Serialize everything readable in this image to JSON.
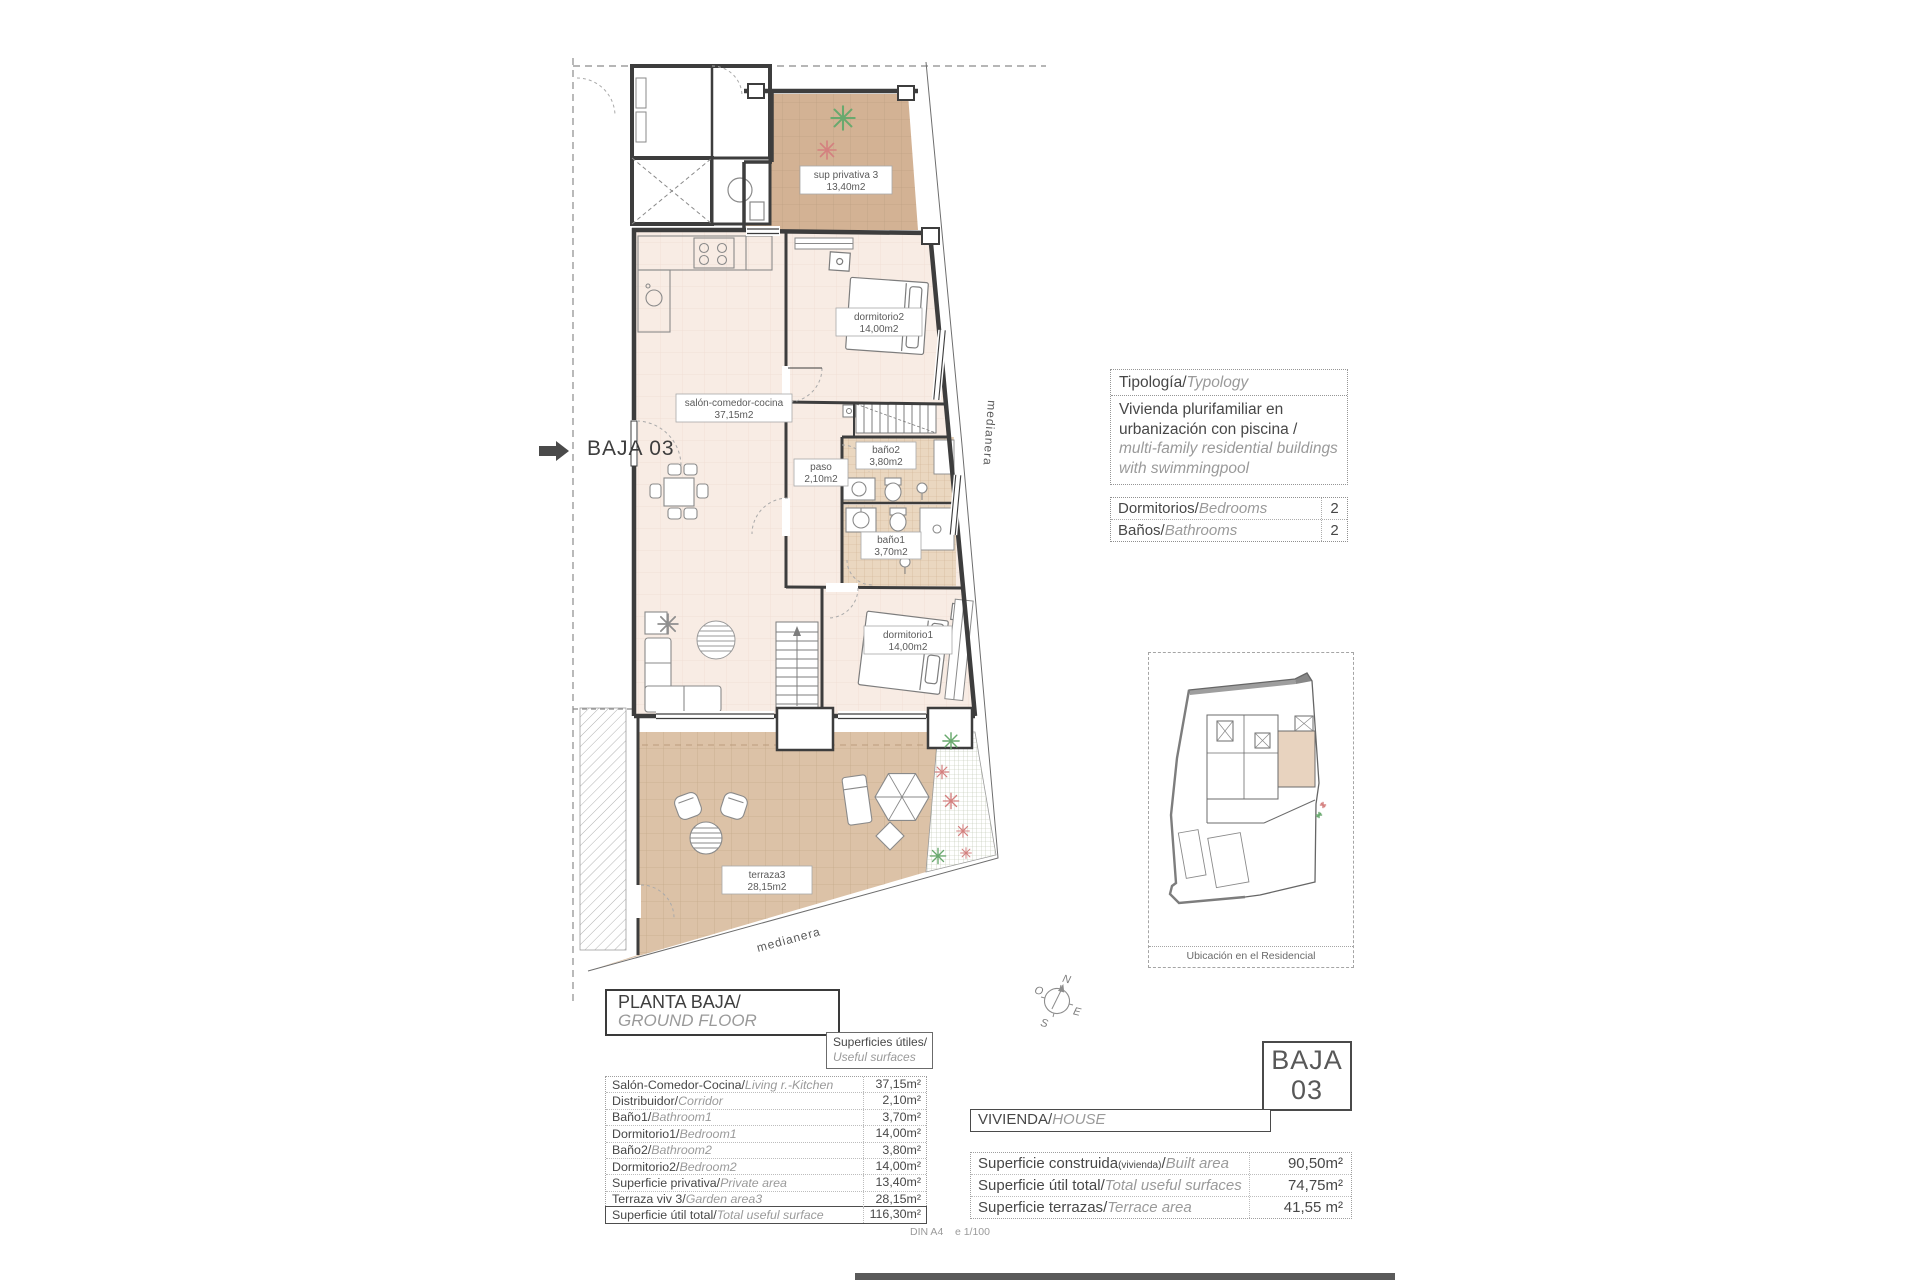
{
  "plan": {
    "arrow_label": "BAJA 03",
    "boundary_label_right": "medianera",
    "boundary_label_bottom": "medianera",
    "compass": {
      "n": "N",
      "s": "S",
      "e": "E",
      "w": "O"
    },
    "rooms": {
      "sup": {
        "name": "sup privativa 3",
        "area": "13,40m2"
      },
      "dorm2": {
        "name": "dormitorio2",
        "area": "14,00m2"
      },
      "salon": {
        "name": "salón-comedor-cocina",
        "area": "37,15m2"
      },
      "paso": {
        "name": "paso",
        "area": "2,10m2"
      },
      "bano2": {
        "name": "baño2",
        "area": "3,80m2"
      },
      "bano1": {
        "name": "baño1",
        "area": "3,70m2"
      },
      "dorm1": {
        "name": "dormitorio1",
        "area": "14,00m2"
      },
      "terraza": {
        "name": "terraza3",
        "area": "28,15m2"
      }
    }
  },
  "typology": {
    "header_es": "Tipología/",
    "header_en": "Typology",
    "l1": "Vivienda plurifamiliar en",
    "l2": "urbanización con piscina  /",
    "l3": "multi-family residential buildings",
    "l4": "with swimmingpool"
  },
  "counts": {
    "rows": [
      {
        "label_es": "Dormitorios/",
        "label_en": "Bedrooms",
        "value": "2"
      },
      {
        "label_es": "Baños/",
        "label_en": "Bathrooms",
        "value": "2"
      }
    ]
  },
  "site_plan": {
    "caption": "Ubicación en el Residencial"
  },
  "floor_title": {
    "es": "PLANTA BAJA/",
    "en": "GROUND FLOOR"
  },
  "useful_surfaces": {
    "header_es": "Superficies útiles/",
    "header_en": "Useful surfaces",
    "rows": [
      {
        "es": "Salón-Comedor-Cocina/",
        "en": "Living r.-Kitchen",
        "value": "37,15m²"
      },
      {
        "es": "Distribuidor/",
        "en": "Corridor",
        "value": "2,10m²"
      },
      {
        "es": "Baño1/",
        "en": "Bathroom1",
        "value": "3,70m²"
      },
      {
        "es": "Dormitorio1/",
        "en": "Bedroom1",
        "value": "14,00m²"
      },
      {
        "es": "Baño2/",
        "en": "Bathroom2",
        "value": "3,80m²"
      },
      {
        "es": "Dormitorio2/",
        "en": "Bedroom2",
        "value": "14,00m²"
      },
      {
        "es": "Superficie privativa/",
        "en": "Private area",
        "value": "13,40m²"
      },
      {
        "es": "Terraza viv 3/",
        "en": "Garden area3",
        "value": "28,15m²"
      },
      {
        "es": "Superficie útil total/",
        "en": "Total useful surface",
        "value": "116,30m²"
      }
    ]
  },
  "unit_badge": {
    "line1": "BAJA",
    "line2": "03"
  },
  "house": {
    "header_es": "VIVIENDA/",
    "header_en": "HOUSE",
    "rows": [
      {
        "es": "Superficie construida",
        "small": "(vivienda)",
        "sep": "/",
        "en": "Built area",
        "value": "90,50m²"
      },
      {
        "es": "Superficie útil total",
        "small": "",
        "sep": "/",
        "en": "Total useful surfaces",
        "value": "74,75m²"
      },
      {
        "es": "Superficie terrazas",
        "small": "",
        "sep": "/",
        "en": "Terrace area",
        "value": "41,55 m²"
      }
    ]
  },
  "footer_note": "DIN A4    e 1/100"
}
